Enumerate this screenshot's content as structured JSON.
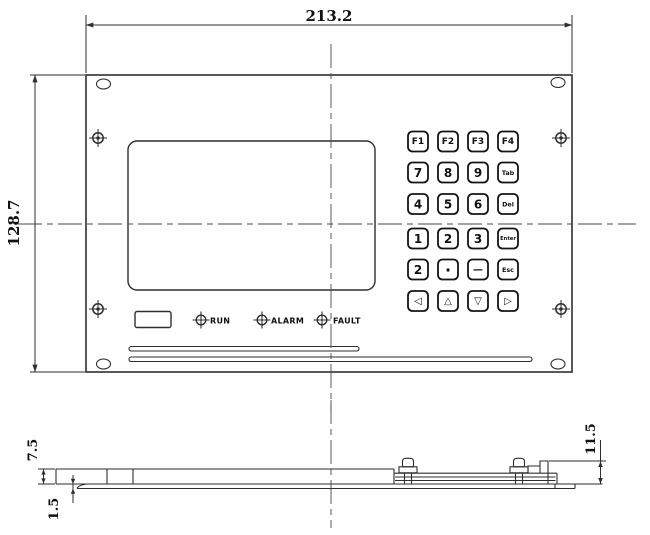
{
  "drawing": {
    "type": "engineering-drawing",
    "subject": "membrane keypad control panel - front and side views"
  },
  "dimensions": {
    "overall_width": "213.2",
    "overall_height": "128.7",
    "panel_depth": "7.5",
    "sheet_thickness": "1.5",
    "rear_height": "11.5"
  },
  "leds": {
    "items": [
      {
        "label": "RUN"
      },
      {
        "label": "ALARM"
      },
      {
        "label": "FAULT"
      }
    ]
  },
  "keypad": {
    "rows": [
      {
        "keys": [
          "F1",
          "F2",
          "F3",
          "F4"
        ]
      },
      {
        "keys": [
          "7",
          "8",
          "9",
          "Tab"
        ]
      },
      {
        "keys": [
          "4",
          "5",
          "6",
          "Del"
        ]
      },
      {
        "keys": [
          "1",
          "2",
          "3",
          "Enter"
        ]
      },
      {
        "keys": [
          "2",
          "·",
          "—",
          "Esc"
        ]
      },
      {
        "keys": [
          "◁",
          "△",
          "▽",
          "▷"
        ]
      }
    ]
  },
  "colors": {
    "line": "#2f2f2f",
    "centerline": "#4a4a4a",
    "background": "#fefefe"
  }
}
